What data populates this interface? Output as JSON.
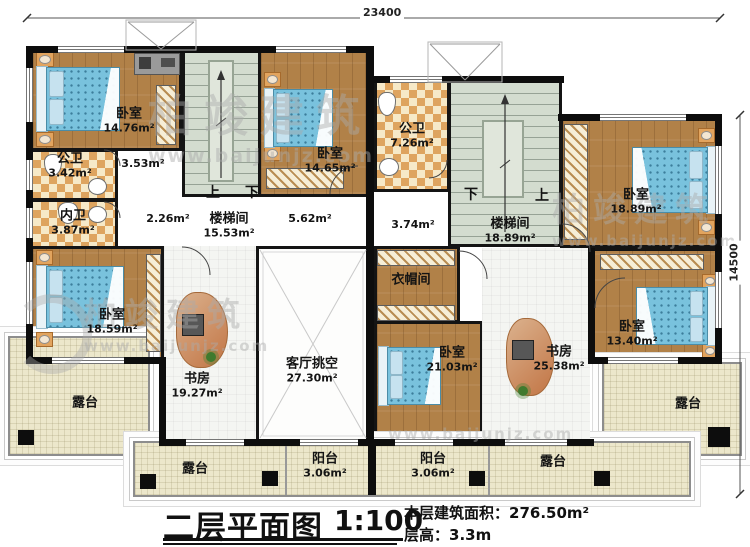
{
  "dimensions": {
    "top": "23400",
    "right": "14500"
  },
  "watermark": {
    "brand": "柏竣建筑",
    "url": "www.baijunjz.com"
  },
  "stairs": {
    "left": {
      "up": "上",
      "down": "下"
    },
    "right": {
      "down": "下",
      "up": "上"
    }
  },
  "rooms": {
    "bedroom_tl": {
      "name": "卧室",
      "area": "14.76m²"
    },
    "bedroom_tm": {
      "name": "卧室",
      "area": "14.65m²"
    },
    "bedroom_tr": {
      "name": "卧室",
      "area": "18.89m²"
    },
    "bedroom_bl": {
      "name": "卧室",
      "area": "18.59m²"
    },
    "bedroom_bm": {
      "name": "卧室",
      "area": "21.03m²"
    },
    "bedroom_br": {
      "name": "卧室",
      "area": "13.40m²"
    },
    "bath_tl": {
      "name": "公卫",
      "area": "3.42m²"
    },
    "bath_inner": {
      "name": "内卫",
      "area": "3.87m²"
    },
    "bath_tr": {
      "name": "公卫",
      "area": "7.26m²"
    },
    "stair_left": {
      "name": "楼梯间",
      "area": "15.53m²"
    },
    "stair_right": {
      "name": "楼梯间",
      "area": "18.89m²"
    },
    "hall_353": {
      "area": "3.53m²"
    },
    "hall_226": {
      "area": "2.26m²"
    },
    "hall_562": {
      "area": "5.62m²"
    },
    "hall_374": {
      "area": "3.74m²"
    },
    "study_left": {
      "name": "书房",
      "area": "19.27m²"
    },
    "study_right": {
      "name": "书房",
      "area": "25.38m²"
    },
    "living_void": {
      "name": "客厅挑空",
      "area": "27.30m²"
    },
    "cloakroom": {
      "name": "衣帽间"
    },
    "terrace_left": {
      "name": "露台"
    },
    "terrace_right": {
      "name": "露台"
    },
    "terrace_bottom_left": {
      "name": "露台"
    },
    "terrace_bottom_right": {
      "name": "露台"
    },
    "balcony_left": {
      "name": "阳台",
      "area": "3.06m²"
    },
    "balcony_right": {
      "name": "阳台",
      "area": "3.06m²"
    }
  },
  "title_block": {
    "title": "二层平面图",
    "scale": "1:100",
    "area_label": "本层建筑面积：",
    "area_value": "276.50m²",
    "height_label": "层高：",
    "height_value": "3.3m"
  }
}
